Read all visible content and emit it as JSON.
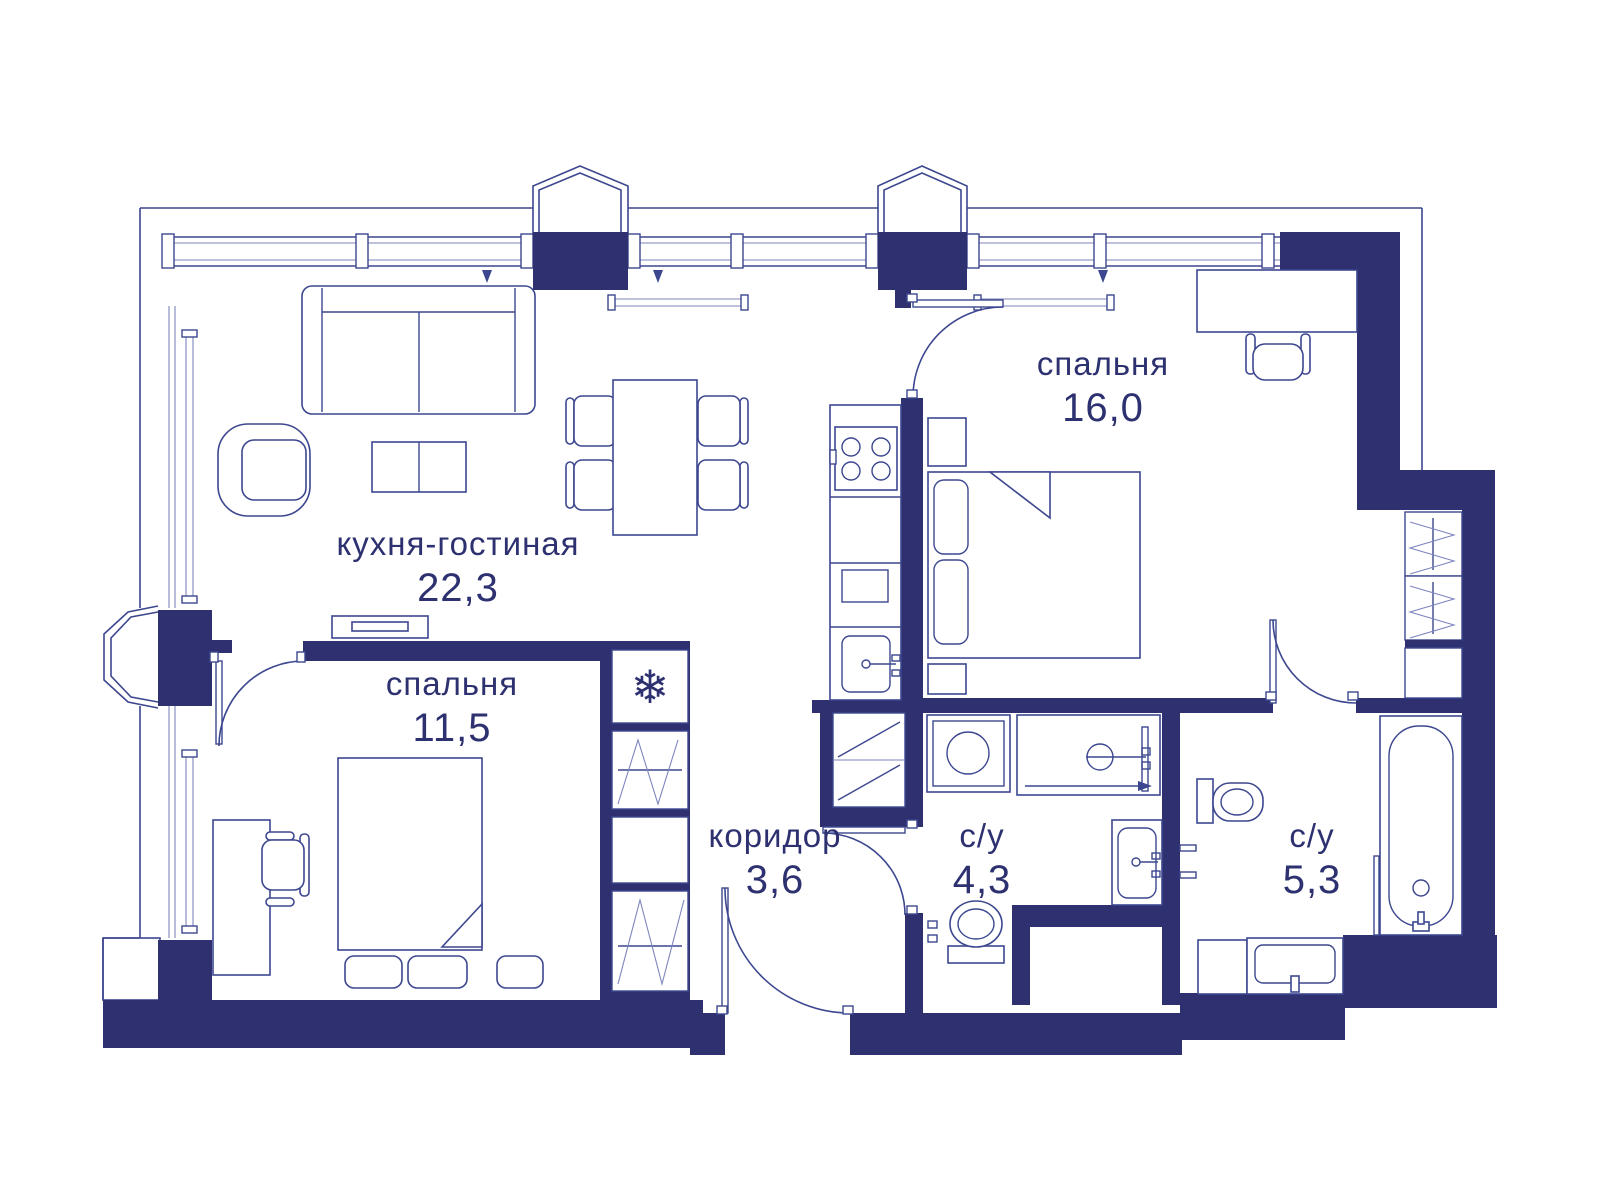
{
  "plan": {
    "rooms": [
      {
        "id": "kitchen_living",
        "label": "кухня-гостиная",
        "area": "22,3"
      },
      {
        "id": "bedroom_large",
        "label": "спальня",
        "area": "16,0"
      },
      {
        "id": "bedroom_small",
        "label": "спальня",
        "area": "11,5"
      },
      {
        "id": "corridor",
        "label": "коридор",
        "area": "3,6"
      },
      {
        "id": "bathroom_small",
        "label": "с/у",
        "area": "4,3"
      },
      {
        "id": "bathroom_large",
        "label": "с/у",
        "area": "5,3"
      }
    ],
    "icons": {
      "fridge_snowflake": "❄"
    },
    "colors": {
      "wall": "#2e3070",
      "line": "#3c478f",
      "text": "#2e3170",
      "background": "#ffffff"
    }
  }
}
